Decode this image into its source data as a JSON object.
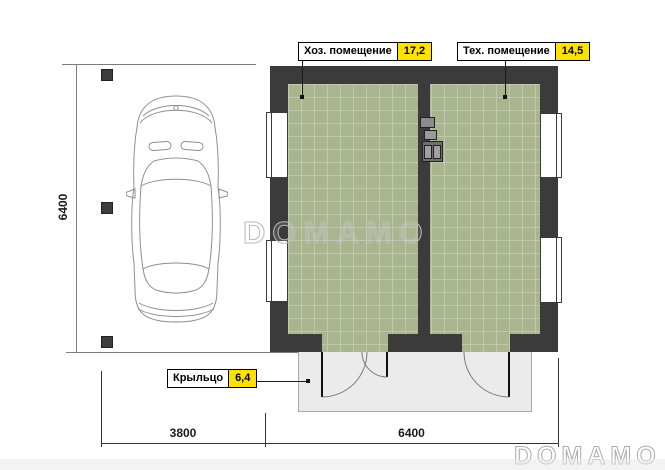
{
  "rooms": [
    {
      "name": "Хоз. помещение",
      "area": "17,2"
    },
    {
      "name": "Тех. помещение",
      "area": "14,5"
    }
  ],
  "porch": {
    "name": "Крыльцо",
    "area": "6,4"
  },
  "dimensions": {
    "left_height": "6400",
    "carport_width": "3800",
    "building_width": "6400"
  },
  "watermark": {
    "center": "DOMAMO",
    "corner": "DOMAMO"
  },
  "colors": {
    "wall": "#3b3b3b",
    "floor": "#a8b58f",
    "floor_grid": "#c0c8ab",
    "area_badge": "#ffe100",
    "porch": "#ebebeb"
  }
}
